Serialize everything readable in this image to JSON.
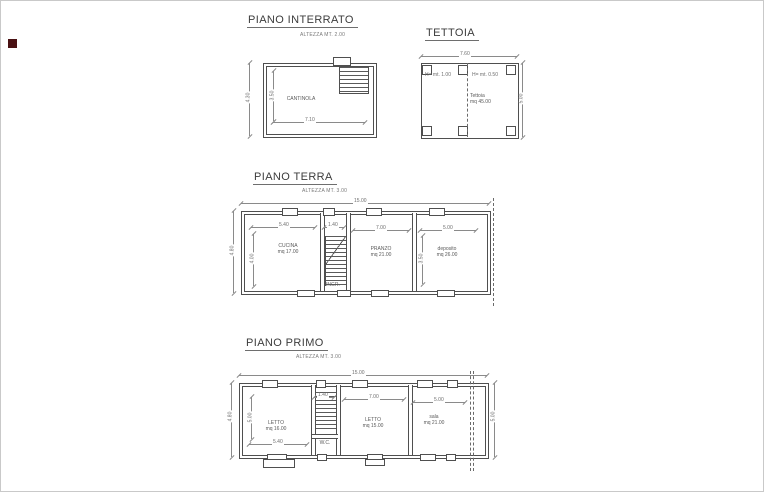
{
  "drawing": {
    "interrato": {
      "title": "PIANO INTERRATO",
      "subtitle": "ALTEZZA MT. 2.00",
      "room": "CANTINOLA",
      "dims": {
        "width": "7.10",
        "inner_height": "3.50",
        "outer_height": "4.30"
      }
    },
    "tettoia": {
      "title": "TETTOIA",
      "h_left": "H= mt. 1.00",
      "h_right": "H= mt. 0.50",
      "area_name": "Tettoia",
      "area_value": "mq 45.00",
      "dims": {
        "width": "7.60",
        "height": "5.00"
      }
    },
    "terra": {
      "title": "PIANO TERRA",
      "subtitle": "ALTEZZA MT. 3.00",
      "rooms": [
        {
          "name": "CUCINA",
          "area": "mq 17.00"
        },
        {
          "name": "PRANZO",
          "area": "mq 21.00"
        },
        {
          "name": "deposito",
          "area": "mq 26.00"
        }
      ],
      "entrance": "INGR.",
      "dims": {
        "total_width": "15.00",
        "room1_width": "5.40",
        "stair_width": "1.40",
        "room2_width": "7.00",
        "room3_width": "5.00",
        "room1_height": "4.00",
        "room3_height": "3.50",
        "outer_height": "4.80"
      }
    },
    "primo": {
      "title": "PIANO PRIMO",
      "subtitle": "ALTEZZA MT. 3.00",
      "rooms": [
        {
          "name": "LETTO",
          "area": "mq 16.00"
        },
        {
          "name": "LETTO",
          "area": "mq 15.00"
        },
        {
          "name": "sala",
          "area": "mq 21.00"
        }
      ],
      "wc": "W.C.",
      "dims": {
        "total_width": "15.00",
        "room1_width": "5.40",
        "stair_width": "1.40",
        "room2_width": "7.00",
        "room3_width": "5.00",
        "room1_height": "5.00",
        "outer_height": "4.80",
        "right_height": "5.00"
      }
    }
  }
}
